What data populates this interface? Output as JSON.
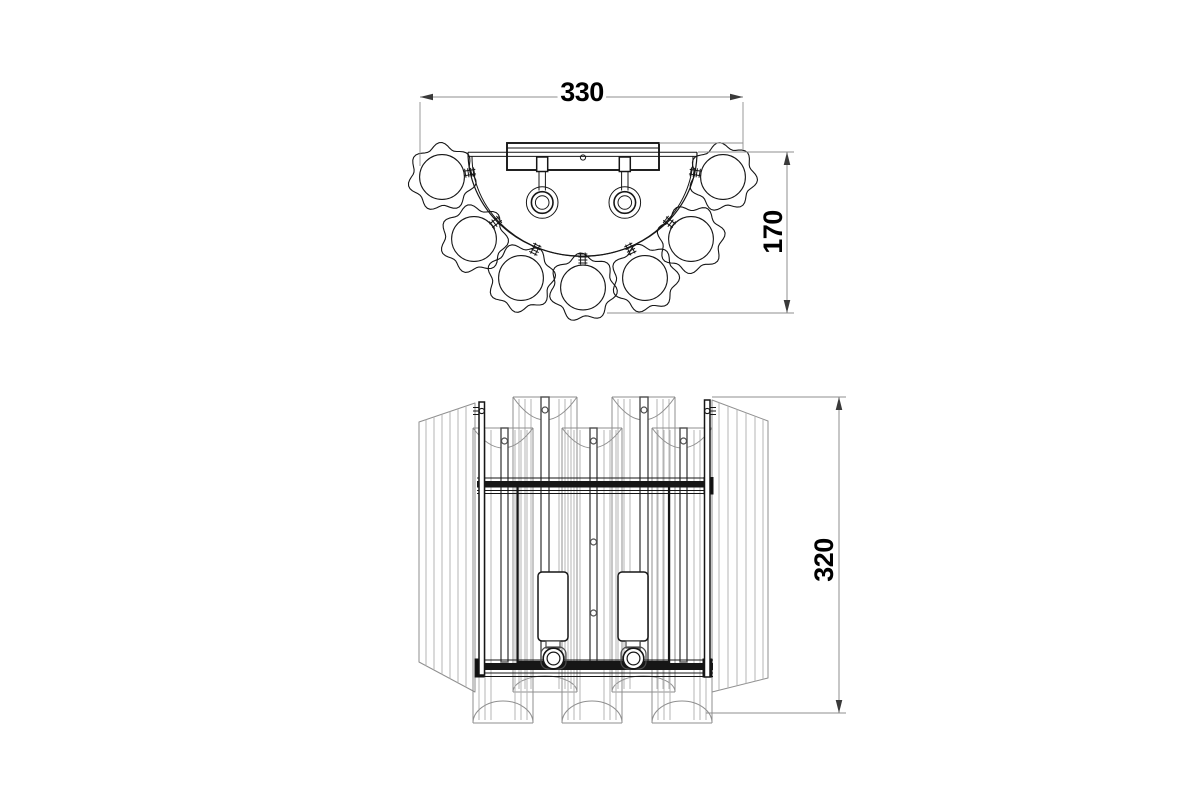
{
  "drawing_title": "wall-lamp-two-view-technical-drawing",
  "colors": {
    "background": "#ffffff",
    "object_dark": "#161616",
    "object_medium": "#4d4d4d",
    "facet_light": "#b4b4b4",
    "outline_gray": "#8f8f8f",
    "dim_line": "#8f8f8f",
    "arrow": "#3a3a3a",
    "text": "#000000"
  },
  "dimensions": {
    "width": {
      "label": "330",
      "line": [
        420,
        97,
        743,
        97
      ],
      "arrows": [
        [
          420,
          97,
          180
        ],
        [
          743,
          97,
          0
        ]
      ],
      "ext": [
        [
          420,
          102,
          420,
          166
        ],
        [
          743,
          102,
          743,
          150
        ]
      ],
      "text_pos": [
        582,
        92
      ],
      "rotate": 0
    },
    "depth": {
      "label": "170",
      "line": [
        787,
        152,
        787,
        313
      ],
      "arrows": [
        [
          787,
          152,
          270
        ],
        [
          787,
          313,
          90
        ]
      ],
      "ext": [
        [
          698,
          152,
          794,
          152
        ],
        [
          607,
          313,
          794,
          313
        ]
      ],
      "text_pos": [
        773,
        232
      ],
      "rotate": -90
    },
    "height": {
      "label": "320",
      "line": [
        839,
        397,
        839,
        713
      ],
      "arrows": [
        [
          839,
          397,
          270
        ],
        [
          839,
          713,
          90
        ]
      ],
      "ext": [
        [
          712,
          397,
          846,
          397
        ],
        [
          706,
          713,
          846,
          713
        ]
      ],
      "text_pos": [
        824,
        560
      ],
      "rotate": -90
    }
  },
  "top_view": {
    "center": [
      582.5,
      154.5
    ],
    "band": {
      "x1": 468,
      "x2": 697,
      "y1": 152.2,
      "y2": 156.4,
      "outer_rx": 114.5,
      "outer_ry": 104,
      "inner_rx": 110.5,
      "inner_ry": 100
    },
    "plate": {
      "x": 507,
      "y": 143,
      "w": 152,
      "h": 27,
      "inner_line_y": 148,
      "hole": [
        583,
        157.5,
        2.6
      ],
      "top_ext": [
        659,
        143,
        743,
        143
      ]
    },
    "lamps": {
      "cx": [
        542.2,
        624.8
      ],
      "clamp_w": 11,
      "clamp_y": 157,
      "clamp_h": 14.5,
      "stem_dx": 3.2,
      "stem_y1": 171.5,
      "stem_y2": 190.5,
      "cy": 202.5,
      "radii": [
        15.8,
        10.8,
        6.8
      ]
    },
    "flowers": {
      "count": 7,
      "outer_r": 31.5,
      "wave_amp": 3.1,
      "lobes": 7,
      "inner_r": 22.4,
      "centers": [
        [
          442,
          177
        ],
        [
          474,
          239
        ],
        [
          521,
          278
        ],
        [
          583,
          287.5
        ],
        [
          645,
          278
        ],
        [
          691,
          239
        ],
        [
          723,
          177
        ]
      ],
      "phases": [
        0.3,
        1.1,
        2.2,
        0.6,
        1.7,
        2.9,
        0.9
      ]
    },
    "clip": {
      "half_len": 6,
      "half_w": 2.3,
      "ticks": [
        -4.5,
        -1.5,
        1.5,
        4.5
      ],
      "tick_half": 4.5
    }
  },
  "front_view": {
    "panels": {
      "left": {
        "xa": 419,
        "xb": 475,
        "top": [
          422,
          403
        ],
        "bot": [
          662,
          692
        ],
        "facets": [
          426,
          434,
          442,
          450,
          458,
          466
        ]
      },
      "right": {
        "xa": 712,
        "xb": 768,
        "top": [
          400,
          421
        ],
        "bot": [
          692,
          678
        ],
        "facets": [
          719,
          728,
          737,
          746,
          755,
          763
        ]
      }
    },
    "back_columns": [
      {
        "x": 513,
        "w": 64,
        "rod_x": 541,
        "rod_w": 8
      },
      {
        "x": 612,
        "w": 63,
        "rod_x": 640,
        "rod_w": 8
      }
    ],
    "back_style": {
      "top": 397,
      "dip": 23,
      "hole_cy": 410,
      "base": 692,
      "apex": 676,
      "facet_off": [
        6,
        12,
        18
      ]
    },
    "front_columns": [
      {
        "x": 473,
        "w": 60,
        "rod_x": 501,
        "rod_w": 7
      },
      {
        "x": 562,
        "w": 60,
        "rod_x": 590,
        "rod_w": 7
      },
      {
        "x": 652,
        "w": 60,
        "rod_x": 680,
        "rod_w": 7
      }
    ],
    "front_style": {
      "top": 428,
      "dip": 20,
      "hole_cy": 441,
      "base": 723,
      "apex": 701,
      "facet_off": [
        6,
        12,
        18
      ]
    },
    "rod_bottom": 662,
    "side_rods": [
      {
        "x": 479,
        "w": 5.5,
        "y1": 402,
        "y2": 675,
        "hole_cy": 411,
        "hatch_side": -1
      },
      {
        "x": 704.5,
        "w": 5.5,
        "y1": 400,
        "y2": 677,
        "hole_cy": 411,
        "hatch_side": 1
      }
    ],
    "rails": {
      "x1": 477,
      "x2": 713,
      "top": {
        "thin": [
          478,
          490.5,
          493.5
        ],
        "band_c": 484.2,
        "band_w": 6.5,
        "caps": [
          [
            704,
            477.5,
            9,
            16.5
          ]
        ]
      },
      "bottom": {
        "thin": [
          660,
          673,
          676.5
        ],
        "band_c": 666.5,
        "band_w": 7,
        "caps": [
          [
            475,
            659,
            9,
            18
          ],
          [
            703,
            659,
            9,
            18
          ]
        ]
      }
    },
    "inner_rect": {
      "x": 517.5,
      "y": 483.5,
      "w": 151.5,
      "h": 178.5
    },
    "panel_holes": [
      [
        593.5,
        542,
        3
      ],
      [
        593.5,
        613,
        3
      ]
    ],
    "candles": [
      {
        "tube": [
          538,
          572,
          30,
          69
        ],
        "neck": [
          546,
          641,
          14,
          7
        ],
        "cup": [
          541,
          647,
          25,
          22
        ],
        "socket": [
          553.5,
          658.5
        ]
      },
      {
        "tube": [
          618,
          572,
          30,
          69
        ],
        "neck": [
          626,
          641,
          14,
          7
        ],
        "cup": [
          621,
          647,
          25,
          22
        ],
        "socket": [
          633.5,
          658.5
        ]
      }
    ],
    "socket_radii": [
      10.3,
      6.4
    ]
  }
}
